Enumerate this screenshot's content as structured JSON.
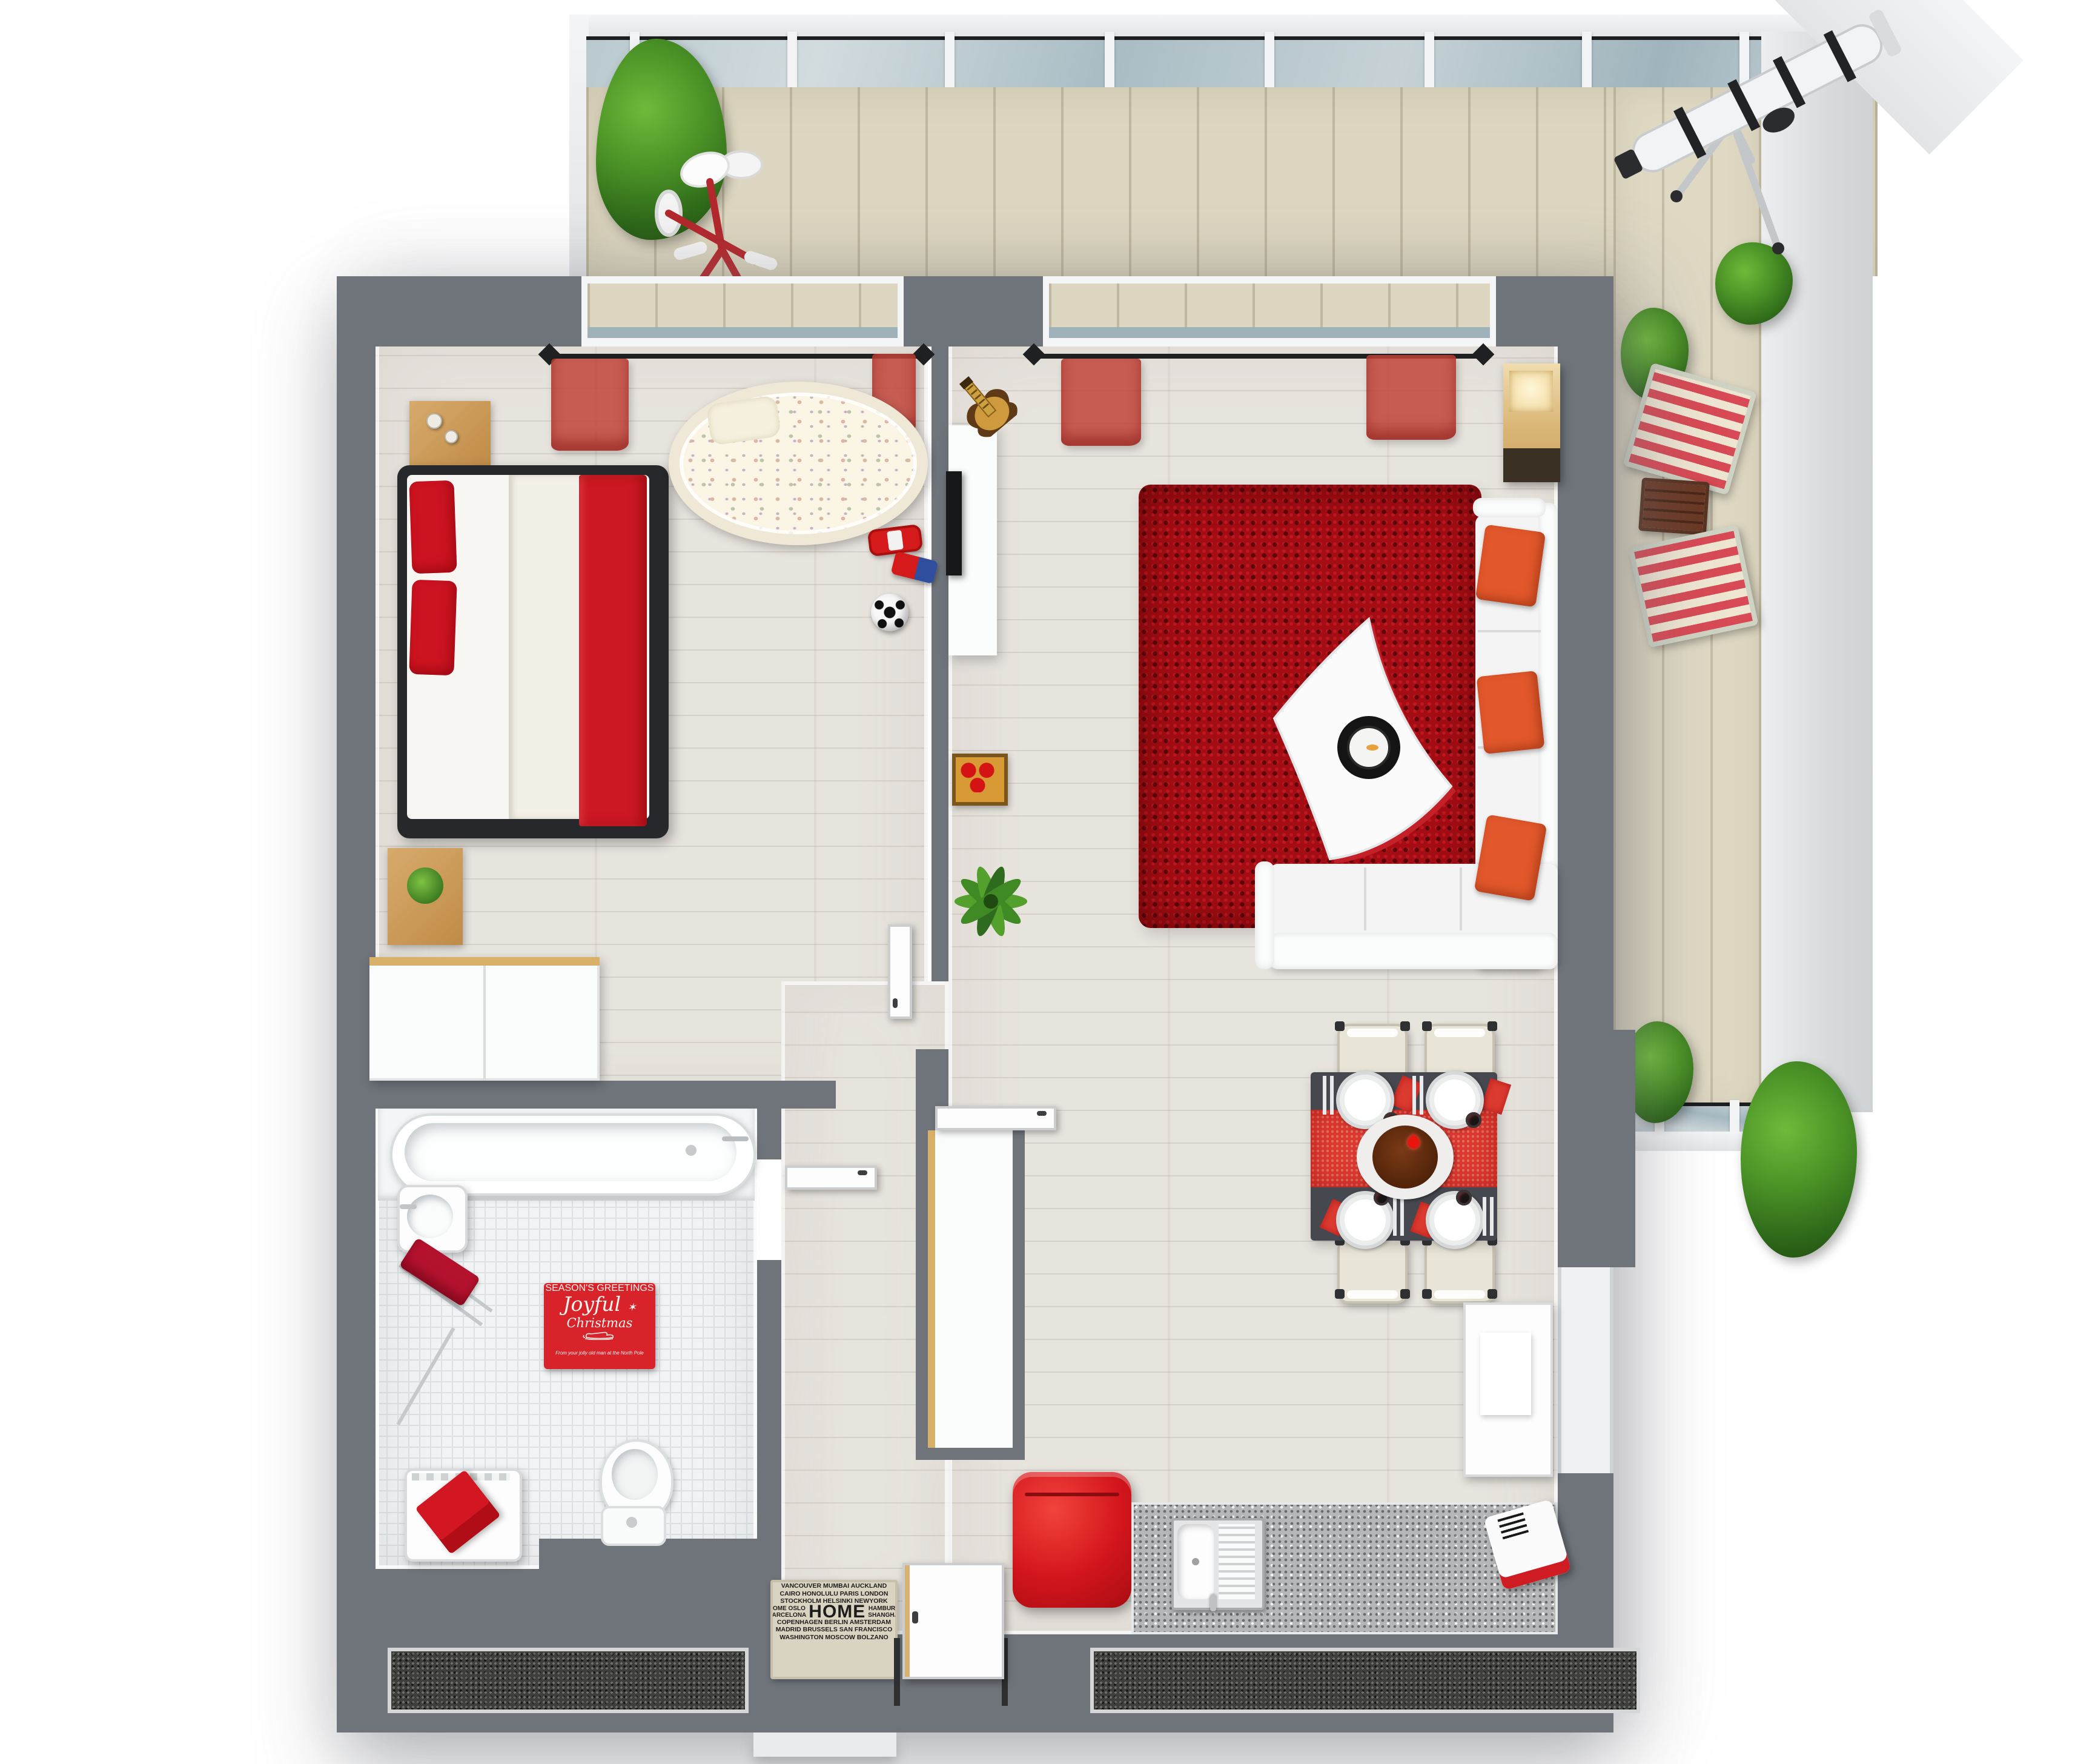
{
  "scene": {
    "description": "3D rendered top-down floor plan of a one-bedroom apartment (bedroom, living/dining room with kitchen corner, bathroom, hall) wrapped by an L-shaped balcony with glass railing",
    "colors": {
      "wall": "#6f747b",
      "room_floor_wood": "#e7e3dd",
      "balcony_deck": "#ddd7c1",
      "bathroom_tile": "#f1f3f4",
      "glass_railing": "#aebfc7",
      "accent_red": "#d2151c",
      "rug_red": "#a30d13",
      "sofa_cushion_orange": "#e2582b",
      "furniture_wood": "#c89a5e",
      "kitchen_counter": "#b6b7b9",
      "dining_table": "#45484e"
    }
  },
  "bath_mat": {
    "header": "SEASON'S GREETINGS",
    "script_line1": "Joyful",
    "script_line2": "Christmas",
    "sparkle": "✶",
    "footer": "From your jolly old man at the North Pole"
  },
  "doormat": {
    "row1": "VANCOUVER MUMBAI AUCKLAND",
    "row2": "CAIRO HONOLULU PARIS LONDON",
    "row3": "STOCKHOLM HELSINKI NEWYORK",
    "mid_left1": "ROME OSLO",
    "mid_left2": "BARCELONA",
    "home": "HOME",
    "mid_right1": "HAMBURG",
    "mid_right2": "SHANGHAI",
    "row5": "COPENHAGEN BERLIN AMSTERDAM",
    "row6": "MADRID BRUSSELS SAN FRANCISCO",
    "row7": "WASHINGTON MOSCOW BOLZANO"
  },
  "semantic_objects": [
    "double-bed",
    "red-pillows",
    "red-blanket",
    "nightstand-with-vases",
    "nightstand-with-plant",
    "baby-crib",
    "toy-car",
    "toy-truck",
    "toy-football",
    "wardrobe",
    "tv-sideboard",
    "tv",
    "guitar",
    "toy-box",
    "potted-plant",
    "red-shag-rug",
    "coffee-table-with-candle",
    "corner-sofa",
    "orange-cushions",
    "wall-shelf-lamp",
    "dining-table",
    "red-table-runner",
    "dinner-plates",
    "dining-chairs",
    "cake-centerpiece",
    "red-retro-fridge",
    "kitchen-counter",
    "kitchen-sink",
    "red-white-appliance",
    "white-cabinet",
    "bathtub",
    "bathroom-sink",
    "towel-rack-red-towel",
    "washing-machine",
    "toilet",
    "christmas-bath-mat",
    "home-door-mat",
    "entrance-door",
    "interior-doors",
    "red-curtains",
    "curtain-rods",
    "balcony-glass-railing",
    "conifer-tree",
    "green-bushes",
    "red-tricycle",
    "striped-deck-chairs",
    "wooden-side-table",
    "telescope",
    "window-planter-boxes"
  ]
}
